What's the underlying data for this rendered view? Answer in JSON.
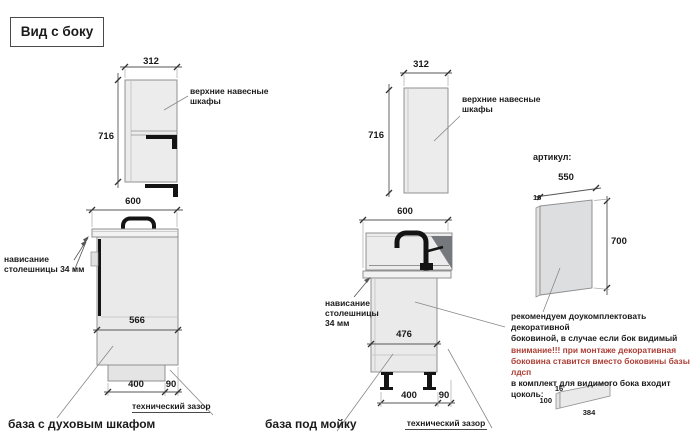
{
  "title": "Вид с боку",
  "colors": {
    "note_red": "#ad3e35",
    "cabinet_fill": "#eaeaea",
    "dark_accent": "#141414"
  },
  "left": {
    "upper": {
      "dim_width": "312",
      "dim_height": "716",
      "label_line1": "верхние навесные",
      "label_line2": "шкафы"
    },
    "base": {
      "dim_width": "600",
      "dim_body": "566",
      "dim_plinth": "400",
      "dim_gap": "90",
      "overhang_line1": "нависание",
      "overhang_line2": "столешницы 34 мм",
      "tech_gap": "технический зазор",
      "caption": "база с духовым шкафом"
    }
  },
  "middle": {
    "upper": {
      "dim_width": "312",
      "dim_height": "716",
      "label_line1": "верхние навесные",
      "label_line2": "шкафы"
    },
    "base": {
      "dim_width": "600",
      "dim_body": "476",
      "dim_plinth": "400",
      "dim_gap": "90",
      "overhang_line1": "нависание",
      "overhang_line2": "столешницы",
      "overhang_line3": "34 мм",
      "tech_gap": "технический зазор",
      "caption": "база под мойку"
    }
  },
  "right": {
    "article_label": "артикул:",
    "side_panel": {
      "dim_width": "550",
      "dim_thickness": "16",
      "dim_height": "700"
    },
    "note": {
      "line1": "рекомендуем доукомплектовать декоративной",
      "line2": "боковиной, в случае если бок видимый",
      "line3": "внимание!!! при монтаже декоративная",
      "line4": "боковина ставится вместо боковины базы лдсп",
      "line5": "в комплект для видимого бока входит цоколь:"
    },
    "plinth": {
      "dim_thickness": "16",
      "dim_height": "100",
      "dim_length": "384"
    }
  }
}
